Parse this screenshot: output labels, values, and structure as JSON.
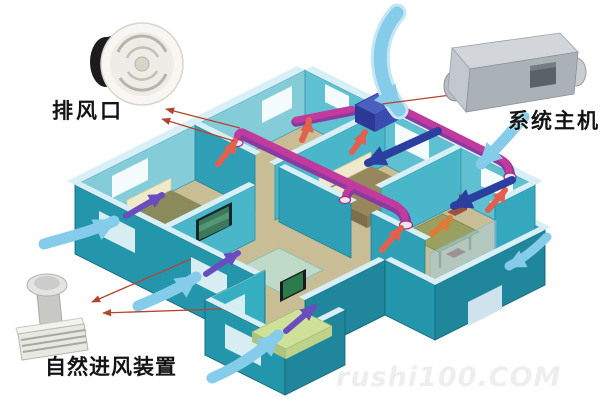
{
  "page": {
    "width": 600,
    "height": 401,
    "background": "#ffffff"
  },
  "diagram": {
    "type": "isometric-house-fresh-air-ventilation-system",
    "callouts": [
      {
        "id": "exhaust-vent",
        "label": "排风口",
        "icon": "round-ceiling-exhaust-vent-photo"
      },
      {
        "id": "system-unit",
        "label": "系统主机",
        "icon": "duct-fan-main-unit-photo"
      },
      {
        "id": "intake-device",
        "label": "自然进风装置",
        "icon": "wall-mounted-air-intake-photo"
      }
    ],
    "watermark": "rushi100.COM",
    "colors": {
      "wall_teal_sw": "#2496ac",
      "wall_teal_se": "#1f869c",
      "wall_inner_nw": "#85ccd9",
      "wall_inner_ne": "#5fc0d2",
      "wall_top": "#d8f0f5",
      "glass": "#9ed2e6",
      "floor_tan": "#c9bd96",
      "floor_wing": "#d9d2b2",
      "floor_bath": "#bcd6e4",
      "duct_magenta": "#c13a9e",
      "duct_purple": "#8a3aa0",
      "exhaust_arrow": "#e2604e",
      "orange_arrow": "#e07a3a",
      "fresh_arrow_light": "#85cbea",
      "fresh_arrow_dark": "#2b3f9f",
      "indoor_arrow_purple": "#6a4cc0",
      "leader_line": "#b5442f",
      "indoor_unit_blue": "#2c3a96"
    }
  }
}
